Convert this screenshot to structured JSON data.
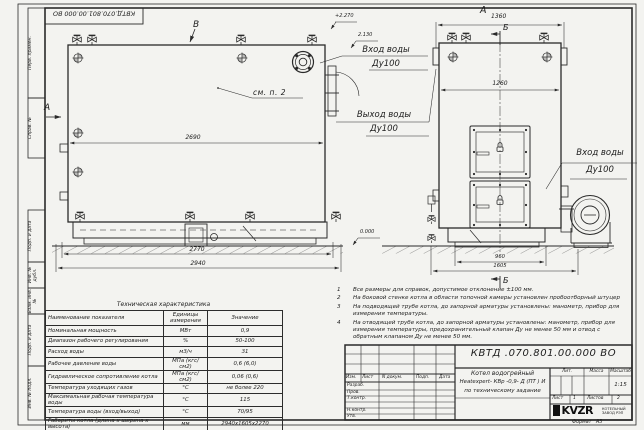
{
  "stamp_top_inverted": "КВТД.070.801.00.000 ВО",
  "left_margin": {
    "labels": [
      "Перв. примен.",
      "Справ. №",
      "Подп. и дата",
      "Инв. № дубл.",
      "Взам. инв. №",
      "Подп. и дата",
      "Инв. № подл."
    ]
  },
  "front_view": {
    "view_label_top": "В",
    "view_label_left": "А",
    "callout": "см. п. 2",
    "dims": {
      "inner_width": "2690",
      "base_width": "2770",
      "overall_width": "2940"
    },
    "elevations": {
      "top": "+2.270",
      "mid": "2.130",
      "zero": "0.000"
    },
    "labels": {
      "inlet": "Вход воды",
      "inlet_dn": "Ду100",
      "outlet": "Выход воды",
      "outlet_dn": "Ду100"
    }
  },
  "side_view": {
    "title": "А",
    "section_top": "Б",
    "section_bottom": "Б",
    "dims": {
      "top_width": "1360",
      "inner_width": "1260",
      "base_width": "960",
      "overall_width": "1605"
    },
    "labels": {
      "inlet": "Вход воды",
      "inlet_dn": "Ду100"
    }
  },
  "notes": [
    {
      "num": "1",
      "text": "Все размеры для справок, допустимое отклонение ±100 мм."
    },
    {
      "num": "2",
      "text": "На боковой стенке котла в области топочной камеры установлен пробоотборный штуцер"
    },
    {
      "num": "3",
      "text": "На  подводящей трубе котла, до запорной арматуры установлены: манометр, прибор для измерения температуры."
    },
    {
      "num": "4",
      "text": "На отводящей трубе котла, до запорной арматуры установлены: манометр, прибор для измерения температуры, предохранительный клапан Ду не менее 50 мм и отвод с обратным клапаном Ду не менее 50 мм."
    }
  ],
  "spec_table": {
    "title": "Техническая характеристика",
    "headers": [
      "Наименование показателя",
      "Единицы измерения",
      "Значение"
    ],
    "rows": [
      [
        "Номинальная мощность",
        "МВт",
        "0,9"
      ],
      [
        "Диапазон рабочего регулирования",
        "%",
        "50-100"
      ],
      [
        "Расход воды",
        "м3/ч",
        "31"
      ],
      [
        "Рабочее давление воды",
        "МПа (кгс/см2)",
        "0,6 (6,0)"
      ],
      [
        "Гидравлическое сопротивление котла",
        "МПа (кгс/см2)",
        "0,06 (0,6)"
      ],
      [
        "Температура уходящих газов",
        "°С",
        "не более 220"
      ],
      [
        "Максимальная рабочая температура воды",
        "°С",
        "115"
      ],
      [
        "Температура воды (вход/выход)",
        "°С",
        "70/95"
      ],
      [
        "Габариты котла (длина х ширина х высота)",
        "мм",
        "2940х1605х2270"
      ]
    ]
  },
  "title_block": {
    "doc_number": "КВТД .070.801.00.000  ВО",
    "header_cells": [
      "Изм.",
      "Лист",
      "N докум.",
      "Подп.",
      "Дата"
    ],
    "row_labels": [
      "Разраб.",
      "Пров.",
      "Т.контр.",
      "Н.контр.",
      "Утв."
    ],
    "name_line1": "Котел водогрейный",
    "name_line2": "Heatexpert- КВр -0,9- Д (ПТ ) И",
    "name_line3": "по техническому задание",
    "lit_label": "Лит.",
    "mass_label": "Масса",
    "scale_label": "Масштаб",
    "scale_value": "1:15",
    "sheet_label": "Лист",
    "sheet_value": "1",
    "sheets_label": "Листов",
    "sheets_value": "2",
    "company_logo": "KVZR",
    "company_name1": "КОТЕЛЬНЫЙ",
    "company_name2": "ЗАВОД РЭП",
    "format_label": "Формат",
    "format_value": "А3"
  }
}
